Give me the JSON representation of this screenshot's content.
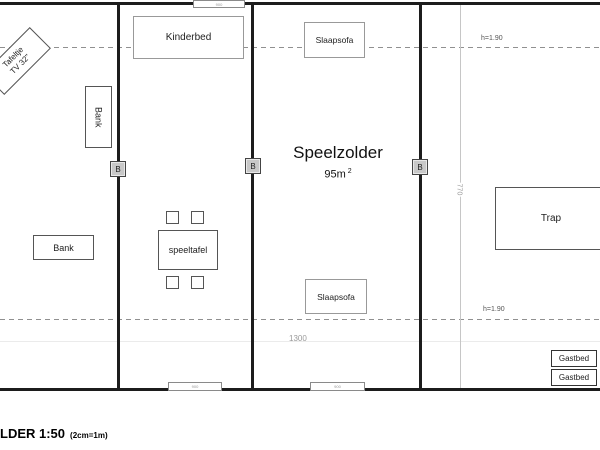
{
  "drawing": {
    "title": "Speelzolder",
    "area_value": "95m",
    "area_exponent": "2",
    "scale_text": "LDER 1:50",
    "scale_note": "(2cm=1m)"
  },
  "furniture": {
    "tafeltje_line1": "Tafeltje",
    "tafeltje_line2": "TV 32\"",
    "bank_left_vertical": "Bank",
    "bank_left_horizontal": "Bank",
    "kinderbed": "Kinderbed",
    "speeltafel": "speeltafel",
    "slaapsofa_top": "Slaapsofa",
    "slaapsofa_bottom": "Slaapsofa",
    "trap": "Trap",
    "gastbed_top": "Gastbed",
    "gastbed_bottom": "Gastbed"
  },
  "annotations": {
    "ceiling_height_top": "h=1.90",
    "ceiling_height_bottom": "h=1.90",
    "room_width": "1300",
    "stair_depth": "770",
    "beam_marker_left": "B",
    "beam_marker_middle": "B",
    "beam_marker_right": "B",
    "dim_tag_top": "900",
    "dim_tag_bottom_left": "900",
    "dim_tag_bottom_middle": "900"
  },
  "colors": {
    "wall": "#1c1c1c",
    "furniture_border": "#555555",
    "light_border": "#999999",
    "dimension_text": "#9a9a9a",
    "marker_fill": "#c8c8c8"
  }
}
